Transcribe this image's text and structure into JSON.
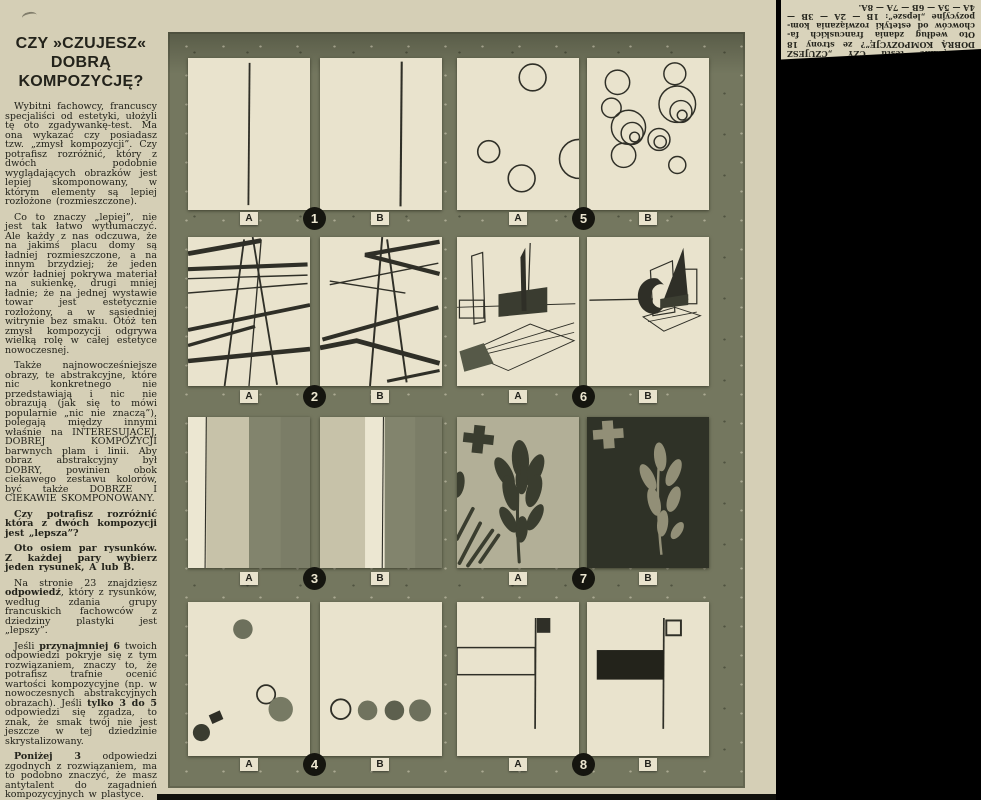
{
  "article": {
    "title": "CZY »CZUJESZ« DOBRĄ KOMPOZYCJĘ?",
    "paragraphs": [
      {
        "segments": [
          {
            "text": "Wybitni fachowcy, francuscy specjaliści od estetyki, ułożyli tę oto zgadywankę-test. Ma ona wykazać czy posiadasz tzw. „zmysł kompozycji”. Czy potrafisz rozróżnić, który z dwóch podobnie wyglądających obrazków jest lepiej skomponowany, w którym elementy są lepiej rozłożone (rozmieszczone).",
            "bold": false
          }
        ]
      },
      {
        "segments": [
          {
            "text": "Co to znaczy „lepiej”, nie jest tak łatwo wytłumaczyć. Ale każdy z nas odczuwa, że na jakimś placu domy są ładniej rozmieszczone, a na innym brzydziej; że jeden wzór ładniej pokrywa materiał na sukienkę, drugi mniej ładnie; że na jednej wystawie towar jest estetycznie rozłożony, a w sąsiedniej witrynie bez smaku. Otóż ten zmysł kompozycji odgrywa wielką rolę w całej estetyce nowoczesnej.",
            "bold": false
          }
        ]
      },
      {
        "segments": [
          {
            "text": "Także najnowocześniejsze obrazy, te abstrakcyjne, które nic konkretnego nie przedstawiają i nic nie obrazują (jak się to mówi popularnie „nic nie znaczą”), polegają między innymi właśnie na INTERESUJĄCEJ, DOBREJ KOMPOZYCJI barwnych plam i linii. Aby obraz abstrakcyjny był DOBRY, powinien obok ciekawego zestawu kolorów, być także DOBRZE I CIEKAWIE SKOMPONOWANY.",
            "bold": false
          }
        ]
      },
      {
        "segments": [
          {
            "text": "Czy potrafisz rozróżnić która z dwóch kompozycji jest „lepsza”?",
            "bold": true
          }
        ]
      },
      {
        "segments": [
          {
            "text": "Oto osiem par rysunków. Z każdej pary wybierz jeden rysunek, A lub B.",
            "bold": true
          }
        ]
      },
      {
        "segments": [
          {
            "text": "Na stronie 23 znajdziesz ",
            "bold": false
          },
          {
            "text": "odpowiedź",
            "bold": true
          },
          {
            "text": ", który z rysunków, według zdania grupy francuskich fachowców z dziedziny plastyki jest „lepszy”.",
            "bold": false
          }
        ]
      },
      {
        "segments": [
          {
            "text": "Jeśli ",
            "bold": false
          },
          {
            "text": "przynajmniej 6",
            "bold": true
          },
          {
            "text": " twoich odpowiedzi pokryje się z tym rozwiązaniem, znaczy to, że potrafisz trafnie ocenić wartości kompozycyjne (np. w nowoczesnych abstrakcyjnych obrazach). Jeśli ",
            "bold": false
          },
          {
            "text": "tylko 3 do 5",
            "bold": true
          },
          {
            "text": " odpowiedzi się zgadza, to znak, że smak twój nie jest jeszcze w tej dziedzinie skrystalizowany.",
            "bold": false
          }
        ]
      },
      {
        "segments": [
          {
            "text": "Poniżej 3",
            "bold": true
          },
          {
            "text": " odpowiedzi zgodnych z rozwiązaniem, ma to podobno znaczyć, że masz antytalent do zagadnień kompozycyjnych w plastyce.",
            "bold": false
          }
        ]
      },
      {
        "segments": [
          {
            "text": "Powyższy test zaczerpnęliśmy z tygodnika francuskiego „L'Express”.",
            "bold": false
          }
        ]
      }
    ]
  },
  "quiz_grid": {
    "pairs": [
      {
        "number": "1",
        "left_label": "A",
        "right_label": "B",
        "art": "single-vertical-line"
      },
      {
        "number": "5",
        "left_label": "A",
        "right_label": "B",
        "art": "outline-circles"
      },
      {
        "number": "2",
        "left_label": "A",
        "right_label": "B",
        "art": "line-abstraction"
      },
      {
        "number": "6",
        "left_label": "A",
        "right_label": "B",
        "art": "constructivist-perspective"
      },
      {
        "number": "3",
        "left_label": "A",
        "right_label": "B",
        "art": "vertical-stripes"
      },
      {
        "number": "7",
        "left_label": "A",
        "right_label": "B",
        "art": "leaf-cutouts"
      },
      {
        "number": "4",
        "left_label": "A",
        "right_label": "B",
        "art": "scattered-dots"
      },
      {
        "number": "8",
        "left_label": "A",
        "right_label": "B",
        "art": "suprematist-rectangles"
      }
    ]
  },
  "answer_clipping": {
    "lines": [
      "Rozwiązanie testu CZY „CZUJESZ",
      "DOBRĄ KOMPOZYCJĘ”? ze strony 18",
      "Oto według zdania francuskich fa-",
      "chowców od estetyki rozwiązania kom-",
      "pozycyjne „lepsze”: 1B — 2A — 3B —",
      "4A — 5A — 6B — 7A — 8A."
    ]
  },
  "colors": {
    "page_bg": "#d5cfb6",
    "grid_bg": "#74775f",
    "panel_bg": "#e9e3cd",
    "ink": "#2f2f27",
    "badge_bg": "#15150f",
    "black_bg": "#000000"
  }
}
